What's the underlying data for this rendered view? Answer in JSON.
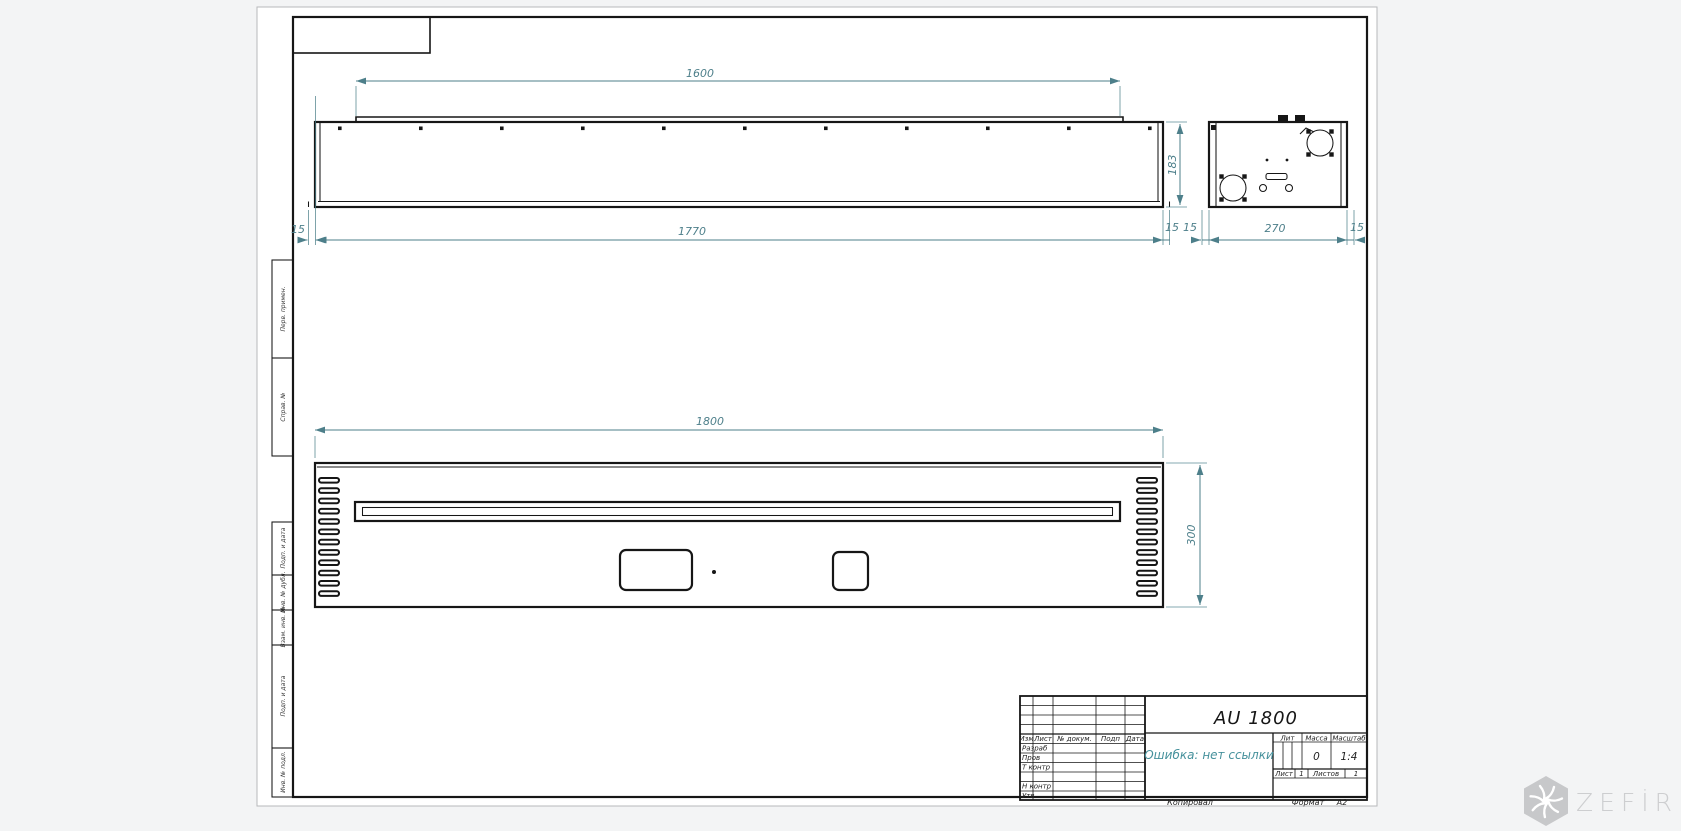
{
  "drawing": {
    "title": "AU 1800",
    "note": "Ошибка: нет ссылки"
  },
  "dims": {
    "lid": "1600",
    "body": "1770",
    "height": "183",
    "flange": "15",
    "end": "270",
    "front_width": "1800",
    "front_height": "300"
  },
  "title_block": {
    "header": {
      "izm": "Изм",
      "list": "Лист",
      "doc": "№ докум.",
      "podp": "Подп",
      "data": "Дата"
    },
    "roles": [
      "Разраб",
      "Пров",
      "Т контр",
      "Н контр",
      "Утв"
    ],
    "lit_label": "Лит",
    "mass_label": "Масса",
    "scale_label": "Масштаб",
    "mass_value": "0",
    "scale_value": "1:4",
    "sheet_label": "Лист",
    "sheet_value": "1",
    "sheets_label": "Листов",
    "sheets_value": "1",
    "copied_label": "Копировал",
    "format_label": "Формат",
    "format_value": "А2"
  },
  "margin_labels": [
    "Перв. примен.",
    "Справ. №",
    "Подп. и дата",
    "Инв. № дубл.",
    "Взам. инв. №",
    "Подп. и дата",
    "Инв. № подл."
  ],
  "watermark": {
    "brand": "ZEFİRE"
  },
  "colors": {
    "dimension": "#4d7f8a",
    "line": "#161616",
    "note": "#46919c",
    "watermark": "#cdced0"
  }
}
